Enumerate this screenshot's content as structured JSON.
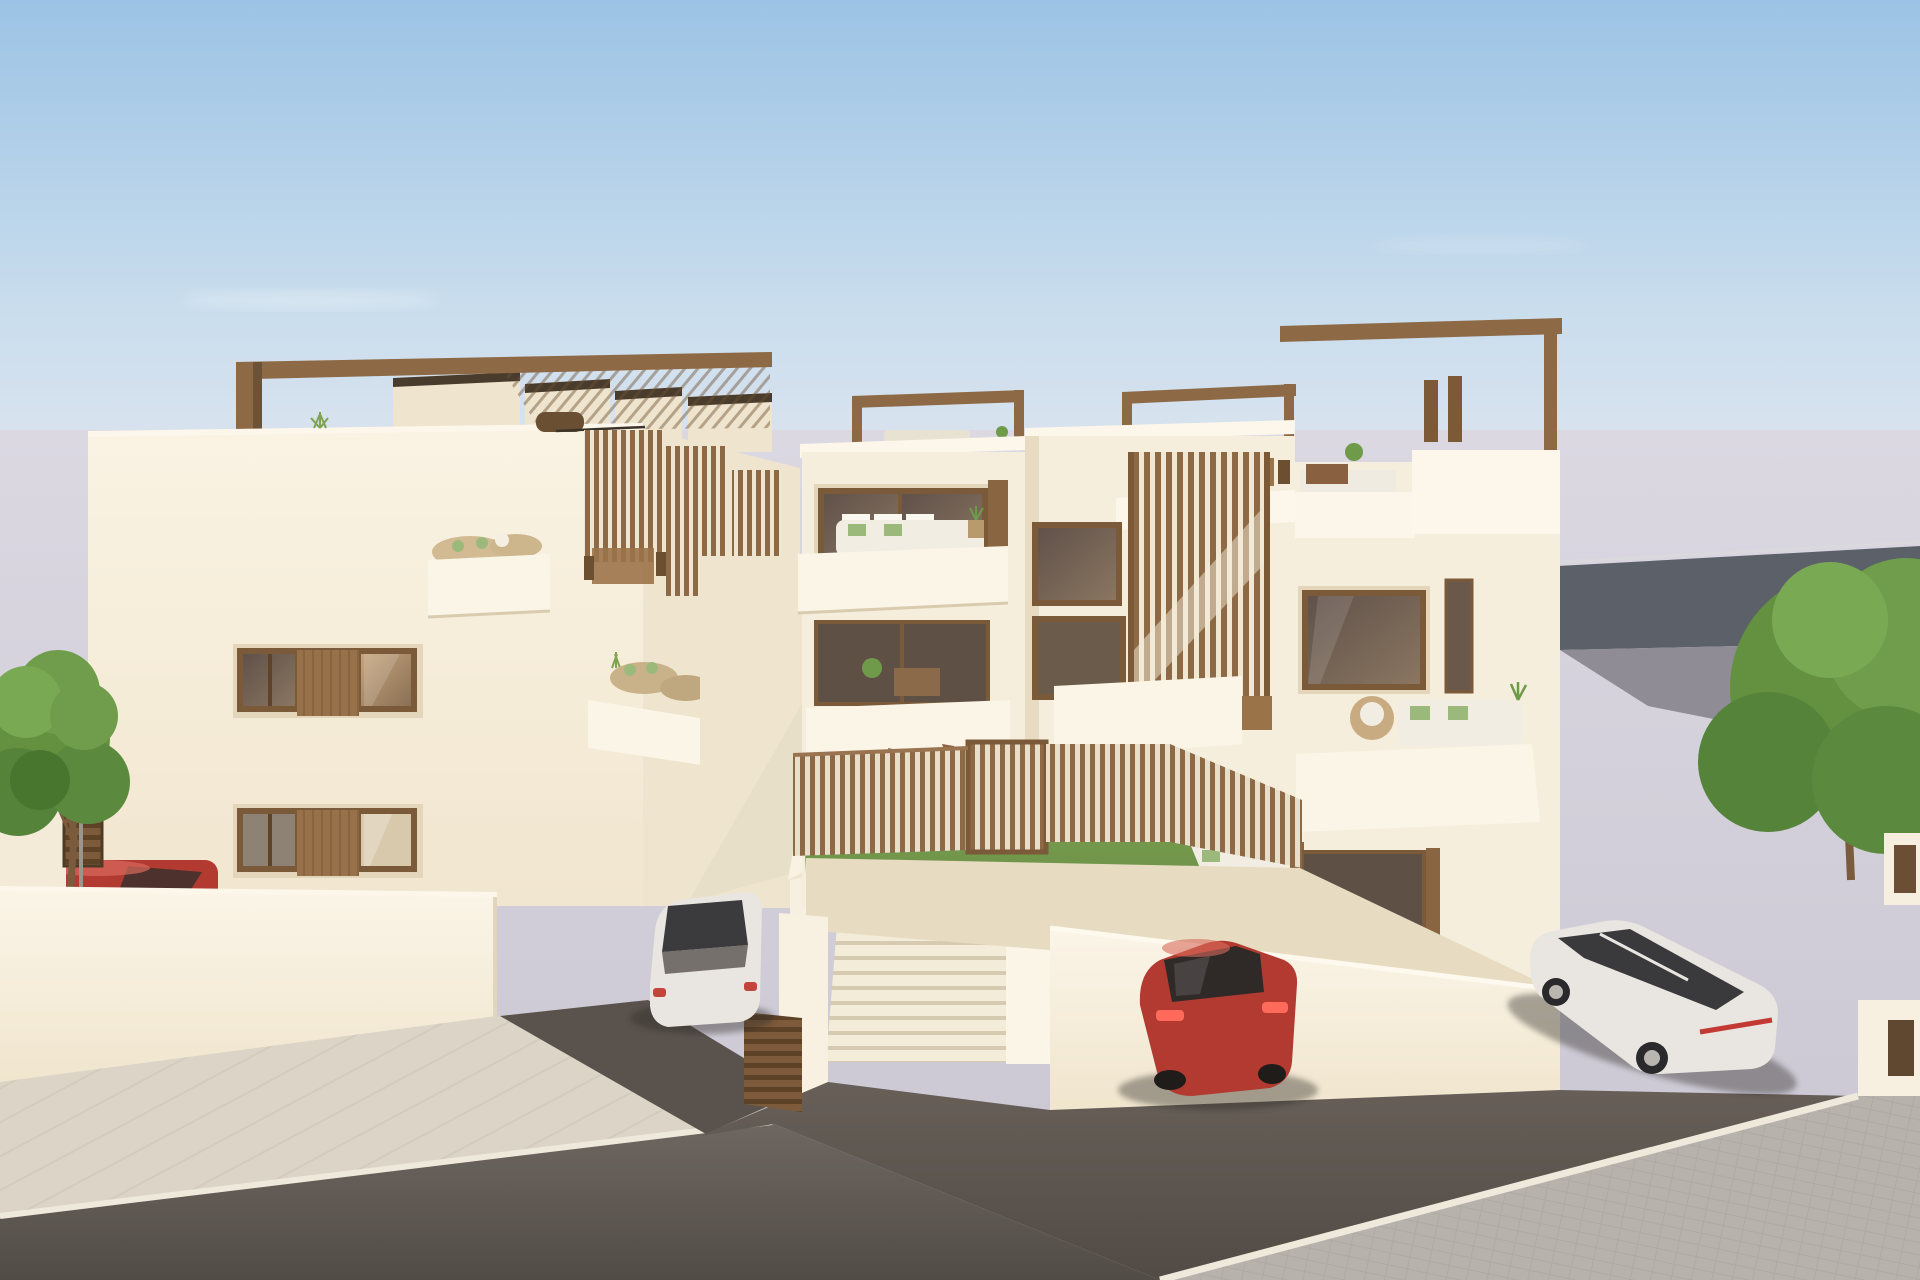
{
  "meta": {
    "type": "3d-architectural-rendering",
    "subject": "Modern white apartment development with wooden slat screens, rooftop pergolas, communal lawn and plunge pool, central staircase walkway, and cars parked on the street",
    "visible_text": "none"
  },
  "palette": {
    "sky_top": "#9cc3e5",
    "sky_mid": "#c9dded",
    "sky_horizon": "#e7e8f0",
    "background_haze": "#dbd8e2",
    "background_ground": "#c9c5d1",
    "facade_light": "#faf3e3",
    "facade_shadow": "#f1e6cf",
    "parapet_white": "#fdf8ec",
    "wood_brown": "#8d6a45",
    "wood_dark": "#5f4730",
    "fascia_dark": "#4a3c2c",
    "glass_dark": "#60514a",
    "glass_warm": "#c5a47c",
    "grass_green": "#7da355",
    "pool_turquoise": "#8fd4d1",
    "sidewalk": "#dcd4c6",
    "road_asphalt": "#6e6761",
    "parking_asphalt": "#675f58",
    "cobble_pavement": "#b7b2ac",
    "car_red": "#b23a31",
    "car_white": "#e9e6e1",
    "car_black": "#1f2124",
    "tree_green": "#639140",
    "trunk_brown": "#7a5b3d",
    "slope_dark": "#5b6069",
    "upper_road_grey": "#8f8c96"
  },
  "scene": {
    "sky": {
      "label": "clear blue morning sky fading to pale lavender horizon, faint cloud wisps"
    },
    "left_building": {
      "label": "three-storey white apartment block",
      "features": [
        "brown rooftop pergola frame",
        "sawtooth stair roofs",
        "two brown-framed window bands with sliding wood shutter",
        "side terraces with wicker furniture",
        "vertical wood slat screens"
      ]
    },
    "right_building": {
      "label": "terraced white apartment block",
      "features": [
        "rooftop pergola beams",
        "roof terraces with outdoor furniture",
        "balconies with white sofas and green cushions",
        "large wood slat stair screen",
        "dark glazed doors"
      ]
    },
    "courtyard": {
      "label": "communal garden",
      "features": [
        "green lawn",
        "turquoise plunge pool",
        "wooden slat fence with gate",
        "three wooden sun loungers"
      ]
    },
    "walkway": {
      "label": "central walkway",
      "features": [
        "white staircase of two flights",
        "parked bicycles",
        "receding wood slat privacy screens"
      ]
    },
    "vehicles": [
      {
        "name": "red-car-left",
        "color_key": "car_red",
        "position": "behind left perimeter wall"
      },
      {
        "name": "white-car",
        "color_key": "car_white",
        "position": "driveway between the buildings"
      },
      {
        "name": "red-car-center",
        "color_key": "car_red",
        "position": "parking lot in front of courtyard wall"
      },
      {
        "name": "white-suv",
        "color_key": "car_white",
        "position": "parking corner at bottom right"
      },
      {
        "name": "black-car",
        "color_key": "car_black",
        "position": "upper road behind right tree"
      }
    ],
    "trees": [
      {
        "name": "tree-left",
        "position": "left sidewalk beside gate"
      },
      {
        "name": "tree-right",
        "position": "right slope at image edge"
      }
    ],
    "ground": [
      "light sidewalk with diagonal joints",
      "dark asphalt street",
      "dark parking asphalt",
      "light cobble pavement bottom-right"
    ],
    "small_items": [
      "rooftop bbq",
      "agave plant",
      "brown garden gates",
      "street lamp post",
      "planters with green plants"
    ]
  }
}
